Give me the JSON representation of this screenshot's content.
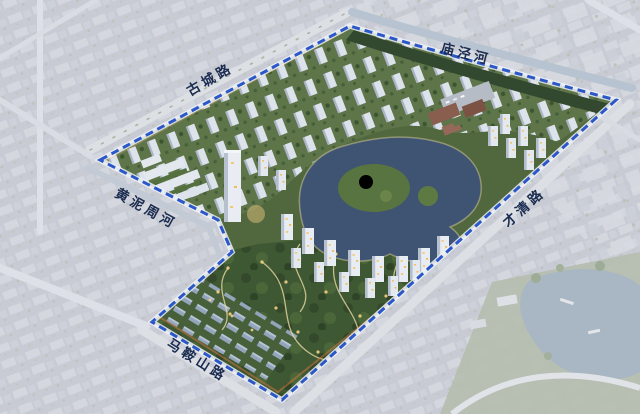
{
  "scene": {
    "title": "residential-masterplan-aerial-rendering",
    "boundary": {
      "style": "dashed",
      "color": "#2b57c9",
      "casing": "#eef2f7"
    },
    "labels": {
      "gucheng_road": "古城路",
      "miaojing_river": "庙泾河",
      "huangnizhou_river": "黄泥周河",
      "caiqing_road": "才清路",
      "maanshan_road": "马鞍山路"
    },
    "colors": {
      "exterior_base": "#c8cbd4",
      "site_green": "#51683f",
      "park_green": "#3e5833",
      "lake_water": "#3f5472",
      "exterior_pond": "#a9b6c3",
      "building_light": "#e8ecf3",
      "label_text": "#1b2c50",
      "path_light": "#e8d9a2",
      "window_glow": "#f5c96e"
    }
  }
}
